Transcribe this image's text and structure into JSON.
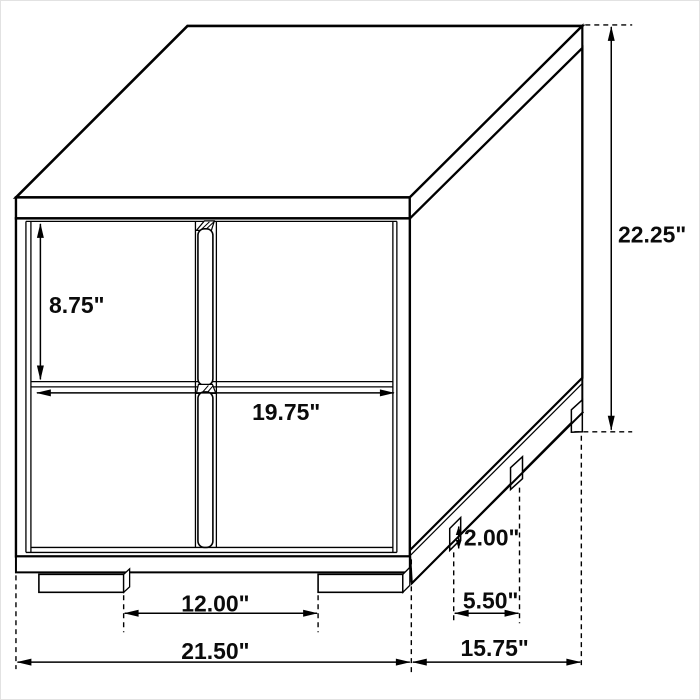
{
  "diagram": {
    "figure": "two-drawer-nightstand-isometric-dimension-drawing",
    "unit": "inches",
    "colors": {
      "line": "#000000",
      "background": "#ffffff",
      "text": "#0b0b0b"
    },
    "labels": {
      "drawer_front_height": "8.75\"",
      "drawer_opening_width": "19.75\"",
      "overall_height": "22.25\"",
      "leg_height": "2.00\"",
      "side_leg_spacing": "5.50\"",
      "front_leg_spacing": "12.00\"",
      "overall_width": "21.50\"",
      "overall_depth": "15.75\""
    }
  }
}
